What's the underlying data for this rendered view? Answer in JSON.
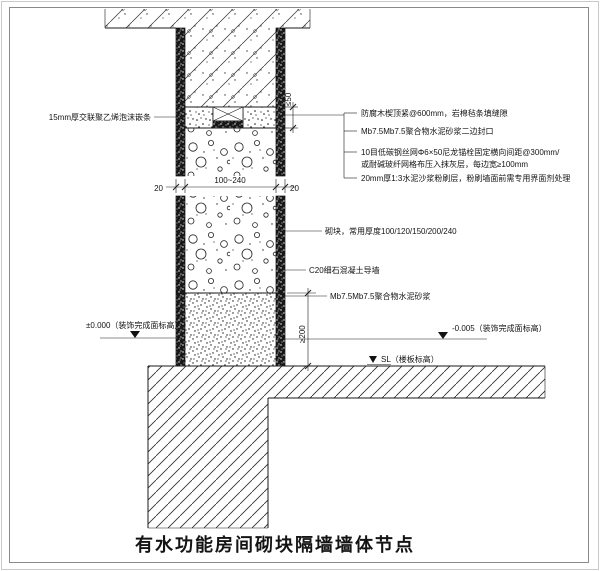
{
  "drawing": {
    "title": "有水功能房间砌块隔墙墙体节点",
    "annotations": {
      "pe_strip": "15mm厚交联聚乙烯泡沫嵌条",
      "top_right": [
        "防腐木楔顶紧@600mm，岩棉毡条填缝隙",
        "Mb7.5Mb7.5聚合物水泥砂浆二边封口",
        "10目低碳钢丝网Φ6×50尼龙锚栓固定横向间距@300mm/",
        "或耐碱玻纤网格布压入抹灰层，每边宽≥100mm",
        "20mm厚1:3水泥沙浆粉刷层，粉刷墙面前需专用界面剂处理"
      ],
      "block": "砌块，常用厚度100/120/150/200/240",
      "curb": "C20细石混凝土导墙",
      "mortar": "Mb7.5Mb7.5聚合物水泥砂浆",
      "level_left": "±0.000（装饰完成面标高）",
      "level_right": "-0.005（装饰完成面标高）",
      "level_slab": "SL（楼板标高）"
    },
    "dimensions": {
      "plaster_left": "20",
      "wall_width": "100~240",
      "plaster_right": "20",
      "top_gap": "≤50",
      "curb_height": "≥200"
    }
  }
}
